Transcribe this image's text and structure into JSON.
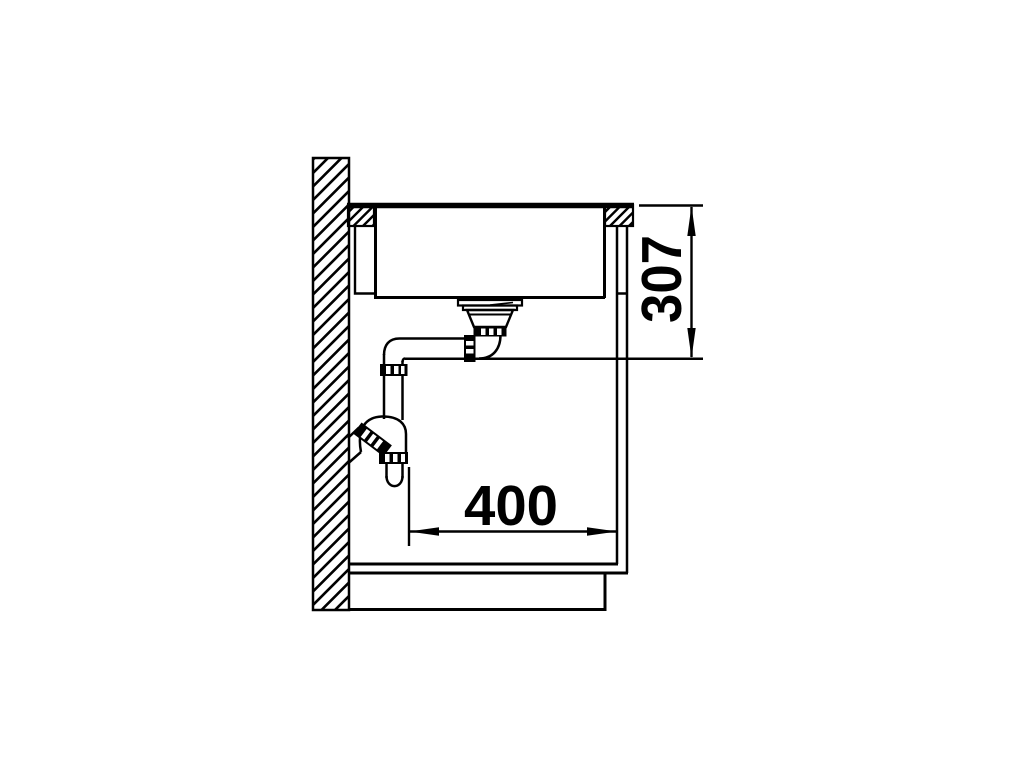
{
  "diagram": {
    "title": "sink-installation-side-section",
    "background_color": "#ffffff",
    "line_color": "#000000",
    "dimensions": [
      {
        "id": "drain-height",
        "label": "307",
        "orientation": "vertical"
      },
      {
        "id": "cabinet-width",
        "label": "400",
        "orientation": "horizontal"
      }
    ]
  }
}
